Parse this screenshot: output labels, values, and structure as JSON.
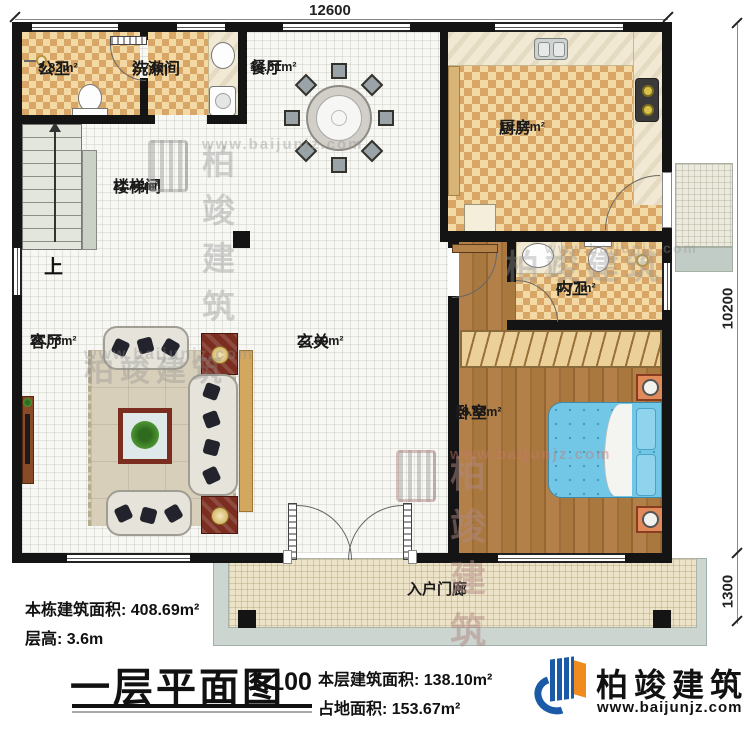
{
  "rooms": {
    "public_bath": {
      "name": "公卫",
      "area": "3.82m²"
    },
    "washroom": {
      "name": "洗漱间",
      "area": "2.74m²"
    },
    "dining": {
      "name": "餐厅",
      "area": "14.61m²"
    },
    "kitchen": {
      "name": "厨房",
      "area": "15.11m²"
    },
    "stairwell": {
      "name": "楼梯间",
      "area": "11.46m²"
    },
    "ensuite_bath": {
      "name": "内卫",
      "area": "4.77m²"
    },
    "bedroom": {
      "name": "卧室",
      "area": "18.88m²"
    },
    "foyer": {
      "name": "玄关",
      "area": "23.69m²"
    },
    "living": {
      "name": "客厅",
      "area": "25.06m²"
    },
    "porch": {
      "name": "入户门廊"
    }
  },
  "stairs": {
    "up_label": "上"
  },
  "dimensions": {
    "top": "12600",
    "right_upper": "10200",
    "right_lower": "1300"
  },
  "title_block": {
    "building_total_label": "本栋建筑面积: 408.69m²",
    "floor_height_label": "层高: 3.6m",
    "plan_title": "一层平面图",
    "plan_scale": "1:100",
    "floor_area_label": "本层建筑面积: 138.10m²",
    "land_area_label": "占地面积: 153.67m²"
  },
  "brand": {
    "name": "柏竣建筑",
    "website": "www.baijunjz.com"
  },
  "watermark": {
    "name": "柏竣建筑",
    "website": "www.baijunjz.com"
  },
  "colors": {
    "brand_blue": "#1a5aa6",
    "brand_orange": "#f08c1e",
    "wall": "#141414",
    "bed_blue": "#72c7e6"
  }
}
